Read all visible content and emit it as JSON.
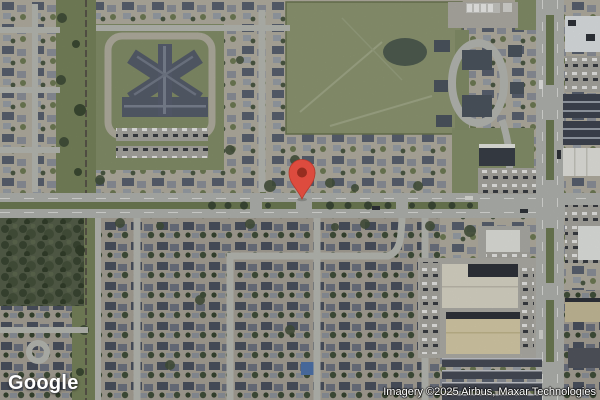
{
  "map": {
    "view_type": "satellite",
    "logo_text": "Google",
    "attribution_text": "Imagery ©2025 Airbus, Maxar Technologies",
    "marker": {
      "x": 302,
      "y": 199,
      "color": "#DD4B3E",
      "inner_color": "#962D20",
      "outline_color": "#B63A2C"
    }
  }
}
